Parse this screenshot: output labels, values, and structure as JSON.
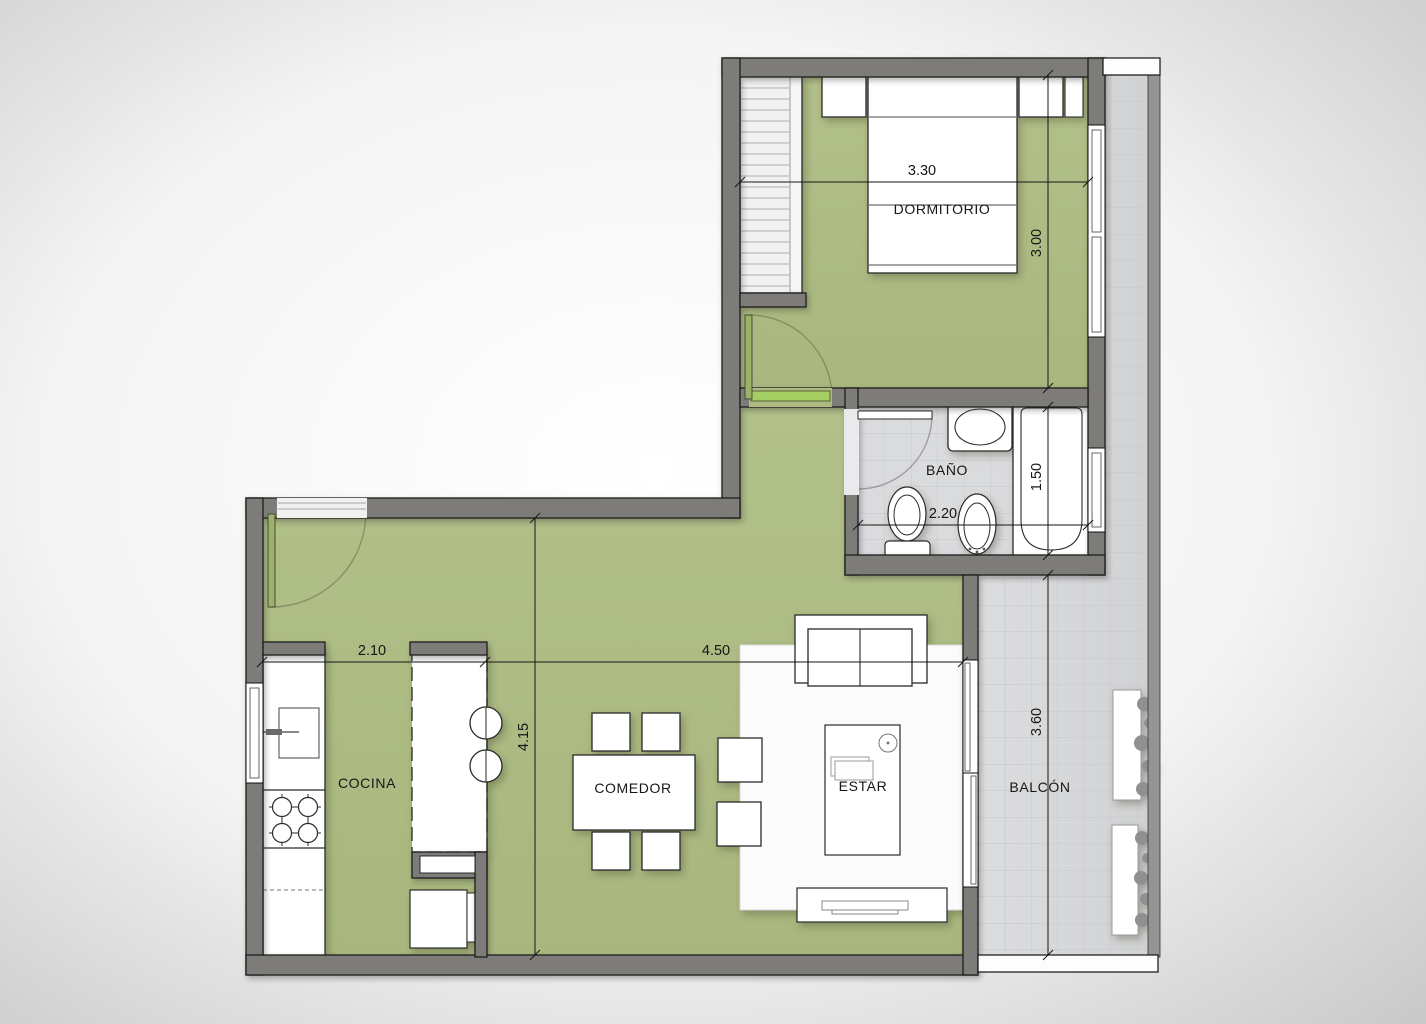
{
  "plan": {
    "type": "apartment-floor-plan",
    "rooms": [
      {
        "id": "dormitorio",
        "label": "DORMITORIO"
      },
      {
        "id": "bano",
        "label": "BAÑO"
      },
      {
        "id": "cocina",
        "label": "COCINA"
      },
      {
        "id": "comedor",
        "label": "COMEDOR"
      },
      {
        "id": "estar",
        "label": "ESTAR"
      },
      {
        "id": "balcon",
        "label": "BALCÓN"
      }
    ],
    "dimensions": {
      "dormitorio_width": "3.30",
      "dormitorio_depth": "3.00",
      "bano_width": "2.20",
      "bano_depth": "1.50",
      "cocina_width": "2.10",
      "estar_width": "4.50",
      "estar_depth": "4.15",
      "balcon_depth": "3.60"
    },
    "colors": {
      "floor_green": "#adbb83",
      "wall_gray": "#7e7b79",
      "tile_gray": "#d8d9db",
      "door_green": "#a6cf63",
      "line_black": "#161616"
    }
  }
}
